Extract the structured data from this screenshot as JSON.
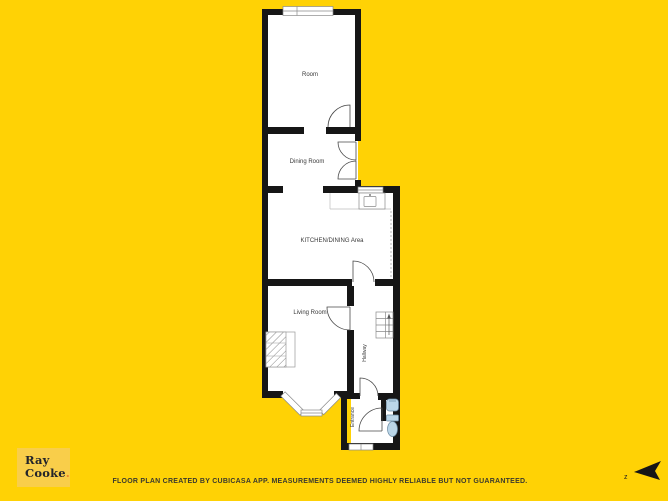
{
  "colors": {
    "background": "#FFD205",
    "wall": "#161616",
    "floor": "#FFFFFF",
    "fixture_blue": "#BBD6E8",
    "logo_box": "#F9CE4A",
    "logo_text": "#23242A",
    "logo_period": "#E8862D",
    "disclaimer_text": "#3B3A2E"
  },
  "floorplan": {
    "rooms": [
      {
        "label": "Room"
      },
      {
        "label": "Dining Room"
      },
      {
        "label": "KITCHEN/DINING Area"
      },
      {
        "label": "Living Room"
      },
      {
        "label": "Hallway"
      },
      {
        "label": "Entrance"
      }
    ],
    "fixtures": [
      "kitchen-sink",
      "counter",
      "fireplace",
      "stairs-up",
      "wc-sink",
      "toilet",
      "bay-window"
    ]
  },
  "branding": {
    "name_line1": "Ray",
    "name_line2": "Cooke",
    "period": "."
  },
  "footer": {
    "disclaimer": "FLOOR PLAN CREATED BY CUBICASA APP. MEASUREMENTS DEEMED HIGHLY RELIABLE BUT NOT GUARANTEED."
  },
  "compass": {
    "label": "z"
  }
}
